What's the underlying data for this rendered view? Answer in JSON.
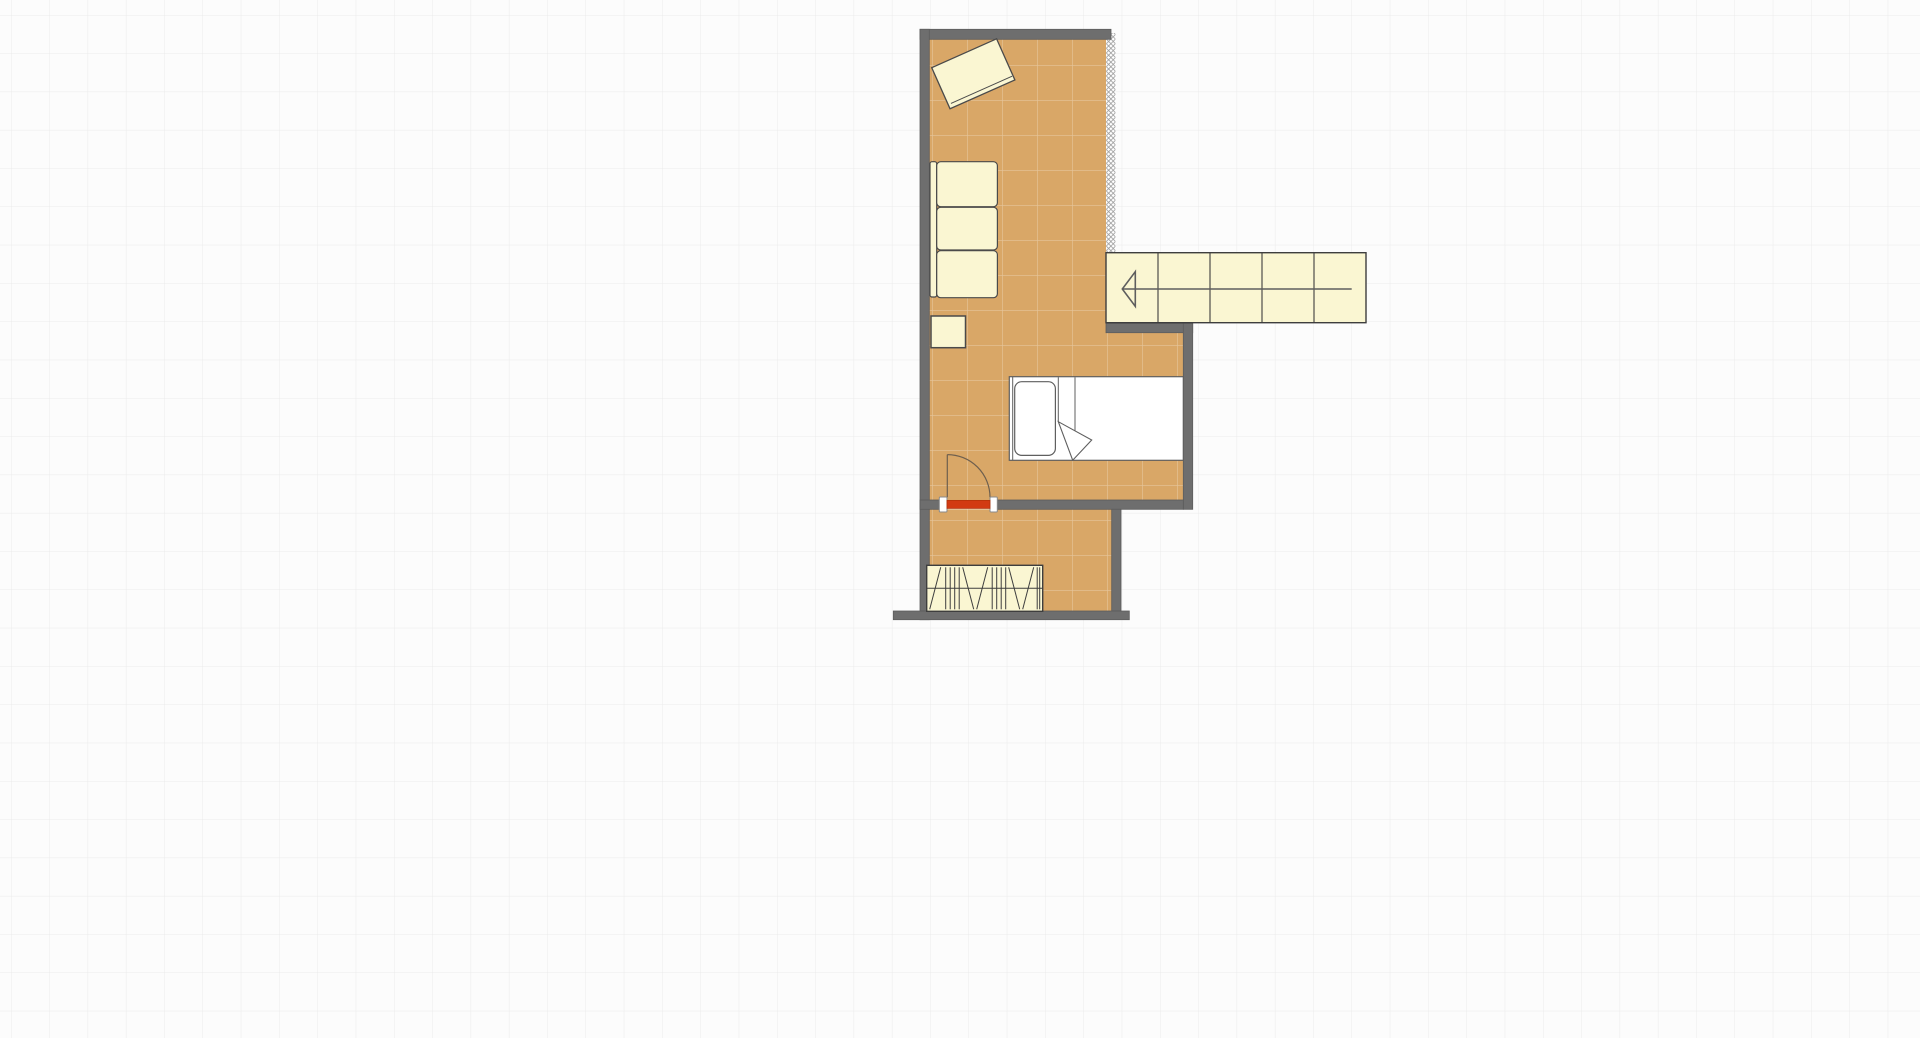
{
  "meta": {
    "app": "floor-plan-editor-canvas",
    "view": "2d-plan"
  },
  "canvas": {
    "width": 1920,
    "height": 1038,
    "background": "#FCFCFC",
    "grid": {
      "spacing": 38.3,
      "offset_x": 11,
      "offset_y": 15,
      "color": "#EBEBEB",
      "line_width": 1
    }
  },
  "palette": {
    "wall_fill": "#6E6E6E",
    "wall_stroke": "#5C5C5C",
    "floor_fill": "#D9A767",
    "floor_tile_line": "rgba(255,255,255,0.35)",
    "floor_tile_spacing": 35,
    "floor_tile_offset_x": 22,
    "floor_tile_offset_y": 30,
    "furniture_fill": "#FAF6D2",
    "furniture_stroke": "#4A4A4A",
    "bed_fill": "#FFFFFF",
    "bed_stroke": "#5F5F5F",
    "door_leaf_fill": "#D23A12",
    "door_leaf_stroke": "#B53209",
    "door_swing_stroke": "#6E5F4E",
    "jamb_fill": "#FFFFFF",
    "jamb_stroke": "#8A8A8A",
    "hatch_line": "#9B9B9B",
    "hatch_bg": "#FFFFFF",
    "stairs_stroke": "#3E3E3E",
    "arrow_stroke": "#5E5E5E"
  },
  "floors": [
    {
      "name": "floor-main-room",
      "x": 929.3,
      "y": 39.3,
      "w": 176.7,
      "h": 460.7
    },
    {
      "name": "floor-bed-alcove",
      "x": 1106,
      "y": 332.7,
      "w": 77.3,
      "h": 167.3
    },
    {
      "name": "floor-lower-room",
      "x": 929.3,
      "y": 509.3,
      "w": 182.4,
      "h": 101.7
    }
  ],
  "walls": [
    {
      "name": "wall-top",
      "x": 920,
      "y": 29.3,
      "w": 191,
      "h": 10
    },
    {
      "name": "wall-left",
      "x": 920,
      "y": 29.3,
      "w": 9.3,
      "h": 590.4
    },
    {
      "name": "wall-under-stairs",
      "x": 1106,
      "y": 323.3,
      "w": 86.7,
      "h": 9.4
    },
    {
      "name": "wall-alcove-right",
      "x": 1183.3,
      "y": 323.3,
      "w": 9.4,
      "h": 186
    },
    {
      "name": "wall-door-left",
      "x": 920,
      "y": 500,
      "w": 19.3,
      "h": 9.3
    },
    {
      "name": "wall-door-right",
      "x": 997.3,
      "y": 500,
      "w": 186,
      "h": 9.3
    },
    {
      "name": "wall-lower-right",
      "x": 1111.7,
      "y": 509.3,
      "w": 9.3,
      "h": 101.7
    },
    {
      "name": "wall-bottom",
      "x": 893.3,
      "y": 611,
      "w": 236,
      "h": 8.7
    }
  ],
  "open_edge": {
    "name": "open-wall-edge",
    "x": 1106.2,
    "y": 33,
    "w": 9.2,
    "h": 219.7,
    "cell": 4.6
  },
  "door": {
    "name": "entry-door",
    "jambs": [
      {
        "x": 939.3,
        "y": 497,
        "w": 7.7,
        "h": 15
      },
      {
        "x": 990,
        "y": 497,
        "w": 7.3,
        "h": 15
      }
    ],
    "leaf": {
      "x": 947,
      "y": 500.4,
      "w": 43,
      "h": 8
    },
    "swing": {
      "cx": 947.3,
      "cy": 497.3,
      "r": 42.7
    }
  },
  "furniture": [
    {
      "type": "desk",
      "name": "desk",
      "cx": 973.3,
      "cy": 73.8,
      "w": 71,
      "h": 45,
      "rotation": -24,
      "front_line_inset": 4.5
    },
    {
      "type": "sofa",
      "name": "sofa",
      "back": {
        "x": 930,
        "y": 161.7,
        "w": 6.7,
        "h": 135.3,
        "r": 2
      },
      "cushions": [
        {
          "x": 936.7,
          "y": 161.7,
          "w": 60.7,
          "h": 45,
          "r": 4
        },
        {
          "x": 936.7,
          "y": 207.3,
          "w": 60.7,
          "h": 42.7,
          "r": 4
        },
        {
          "x": 936.7,
          "y": 250.7,
          "w": 60.7,
          "h": 47,
          "r": 4
        }
      ]
    },
    {
      "type": "table",
      "name": "side-table",
      "x": 931,
      "y": 316,
      "w": 34.5,
      "h": 31.7
    },
    {
      "type": "stairs",
      "name": "stairs",
      "x": 1106,
      "y": 252.7,
      "w": 260,
      "h": 70,
      "treads_x": [
        1158,
        1210,
        1262,
        1314
      ],
      "arrow": {
        "tip_x": 1122.3,
        "head_x": 1135.3,
        "half_h": 17.3,
        "y": 289,
        "end_x": 1351.7
      }
    },
    {
      "type": "bed",
      "name": "single-bed",
      "x": 1009.3,
      "y": 376.7,
      "w": 174,
      "h": 83.6,
      "head_line_x": 1012.7,
      "pillow": {
        "x": 1014.7,
        "y": 381.7,
        "w": 40.7,
        "h": 73.7,
        "r": 7
      },
      "fold_lines": [
        {
          "x": 1058.3,
          "y1": 377.2,
          "y2": 421.7
        },
        {
          "x": 1075,
          "y1": 377.2,
          "y2": 443
        }
      ],
      "fold_triangle": [
        [
          1058.3,
          421.7
        ],
        [
          1091.7,
          440
        ],
        [
          1072.7,
          460.2
        ]
      ]
    },
    {
      "type": "radiator",
      "name": "radiator",
      "x": 926.7,
      "y": 565.3,
      "w": 116,
      "h": 46,
      "stripes": [
        {
          "t": "d",
          "x1": 3,
          "y1": 44,
          "x2": 14,
          "y2": 2
        },
        {
          "t": "v",
          "x": 19
        },
        {
          "t": "v",
          "x": 23.5
        },
        {
          "t": "v",
          "x": 28
        },
        {
          "t": "v",
          "x": 32.5
        },
        {
          "t": "d",
          "x1": 36,
          "y1": 2,
          "x2": 47,
          "y2": 44
        },
        {
          "t": "d",
          "x1": 50,
          "y1": 44,
          "x2": 61,
          "y2": 2
        },
        {
          "t": "v",
          "x": 65.5
        },
        {
          "t": "v",
          "x": 70
        },
        {
          "t": "v",
          "x": 74.5
        },
        {
          "t": "v",
          "x": 79
        },
        {
          "t": "d",
          "x1": 82,
          "y1": 2,
          "x2": 93,
          "y2": 44
        },
        {
          "t": "d",
          "x1": 96,
          "y1": 44,
          "x2": 107,
          "y2": 2
        },
        {
          "t": "v",
          "x": 110.5
        },
        {
          "t": "v",
          "x": 113
        }
      ]
    }
  ]
}
